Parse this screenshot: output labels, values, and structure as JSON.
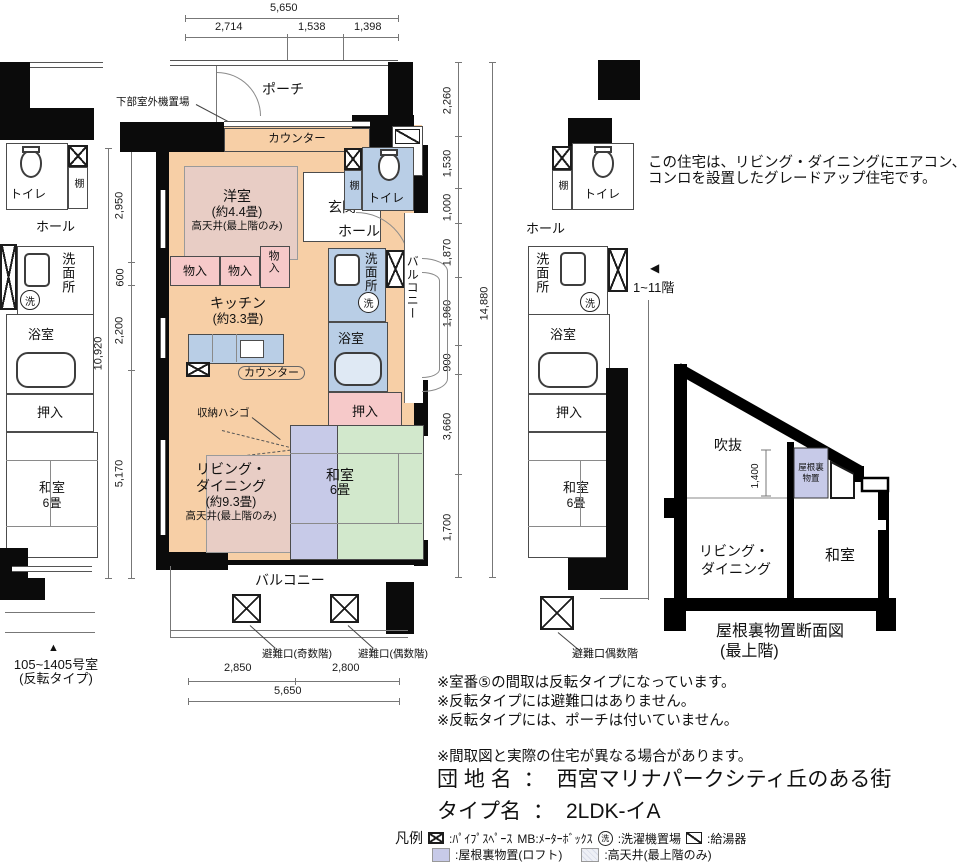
{
  "colors": {
    "room_peach": "#f7cfa6",
    "wet_blue": "#b9cee6",
    "closet_pink": "#f6c9c9",
    "loft_lavender": "#c7cae8",
    "tatami_green": "#d2e8cc",
    "high_ceiling": "#e8cdc5",
    "high_ceiling_swatch": "#dfe3ee",
    "wall_black": "#0b0b0b"
  },
  "dims": {
    "top_total": "5,650",
    "top_segments": [
      "2,714",
      "1,538",
      "1,398"
    ],
    "left_total": "10,920",
    "left_segments": [
      "2,950",
      "600",
      "2,200",
      "5,170"
    ],
    "right_total": "14,880",
    "right_segments": [
      "2,260",
      "1,530",
      "1,000",
      "1,870",
      "1,960",
      "900",
      "3,660",
      "1,700"
    ],
    "bottom_total": "5,650",
    "bottom_segments": [
      "2,850",
      "2,800"
    ],
    "section_height": "1,400"
  },
  "rooms": {
    "porch": "ポーチ",
    "outdoor_unit": "下部室外機置場",
    "counter": "カウンター",
    "mb": "MB",
    "western": "洋室",
    "western_size": "(約4.4畳)",
    "high_ceiling_note": "高天井(最上階のみ)",
    "entrance": "玄関",
    "shelf": "棚",
    "toilet": "トイレ",
    "hall": "ホール",
    "closet": "物入",
    "kitchen": "キッチン",
    "kitchen_size": "(約3.3畳)",
    "washroom": "洗面所",
    "washer_mark": "洗",
    "bath": "浴室",
    "oshiire": "押入",
    "ladder": "収納ハシゴ",
    "living1": "リビング・",
    "living2": "ダイニング",
    "living_size": "(約9.3畳)",
    "washitsu": "和室",
    "washitsu_size": "6畳",
    "balcony": "バルコニー"
  },
  "labels": {
    "hatch_odd": "避難口(奇数階)",
    "hatch_even": "避難口(偶数階)",
    "hatch_even_right": "避難口偶数階"
  },
  "captions": {
    "left_arrow": "▲",
    "left_unit1": "105~1405号室",
    "left_unit2": "(反転タイプ)",
    "floors_arrow": "◀",
    "floors": "1~11階",
    "desc1": "この住宅は、リビング・ダイニングにエアコン、",
    "desc2": "コンロを設置したグレードアップ住宅です。"
  },
  "section": {
    "void": "吹抜",
    "loft1": "屋根裏",
    "loft2": "物置",
    "living1": "リビング・",
    "living2": "ダイニング",
    "washitsu": "和室",
    "caption1": "屋根裏物置断面図",
    "caption2": "(最上階)"
  },
  "notes": [
    "※室番⑤の間取は反転タイプになっています。",
    "※反転タイプには避難口はありません。",
    "※反転タイプには、ポーチは付いていません。",
    "※間取図と実際の住宅が異なる場合があります。"
  ],
  "estate": {
    "label": "団 地 名",
    "colon": "：",
    "value": "西宮マリナパークシティ丘のある街"
  },
  "type": {
    "label": "タイプ名",
    "colon": "：",
    "value": "2LDK-イA"
  },
  "legend": {
    "title": "凡例",
    "pipe": ":ﾊﾟｲﾌﾟｽﾍﾟｰｽ",
    "mb": "MB:ﾒｰﾀｰﾎﾞｯｸｽ",
    "washer": ":洗濯機置場",
    "heater": ":給湯器",
    "loft": ":屋根裏物置(ロフト)",
    "ceiling": ":高天井(最上階のみ)"
  }
}
